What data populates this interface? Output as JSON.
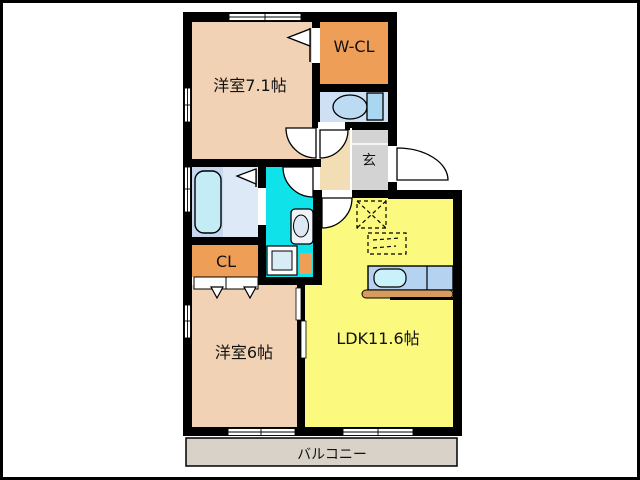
{
  "plan": {
    "title": "apartment-floor-plan",
    "rooms": [
      {
        "name": "western-room-1",
        "label": "洋室7.1帖"
      },
      {
        "name": "walk-in-closet",
        "label": "W-CL"
      },
      {
        "name": "entrance",
        "label": "玄"
      },
      {
        "name": "closet",
        "label": "CL"
      },
      {
        "name": "western-room-2",
        "label": "洋室6帖"
      },
      {
        "name": "ldk",
        "label": "LDK11.6帖"
      },
      {
        "name": "balcony",
        "label": "バルコニー"
      }
    ],
    "fixtures": [
      "bathtub",
      "toilet",
      "washbasin",
      "washing-machine",
      "kitchen-sink",
      "refrigerator-space",
      "dining-space"
    ],
    "colors": {
      "wall": "#000000",
      "room_peach": "#F2D2B5",
      "closet_orange": "#EF9E58",
      "ldk_yellow": "#FBF97E",
      "washroom_cyan": "#10E2EA",
      "bathroom_blue": "#C6D7EE",
      "bathroom_light": "#DDE9F7",
      "bathtub_blue": "#C3ECF7",
      "toilet_floor": "#CFE0F4",
      "toilet_tank": "#A9D7F1",
      "hall_beige": "#F2DDB4",
      "entrance_gray": "#D3D3D3",
      "balcony_gray": "#D9D2C8",
      "counter_blue": "#B5D2F0",
      "sink_cyan": "#C9F1F9",
      "counter_edge": "#D89B5E"
    }
  }
}
